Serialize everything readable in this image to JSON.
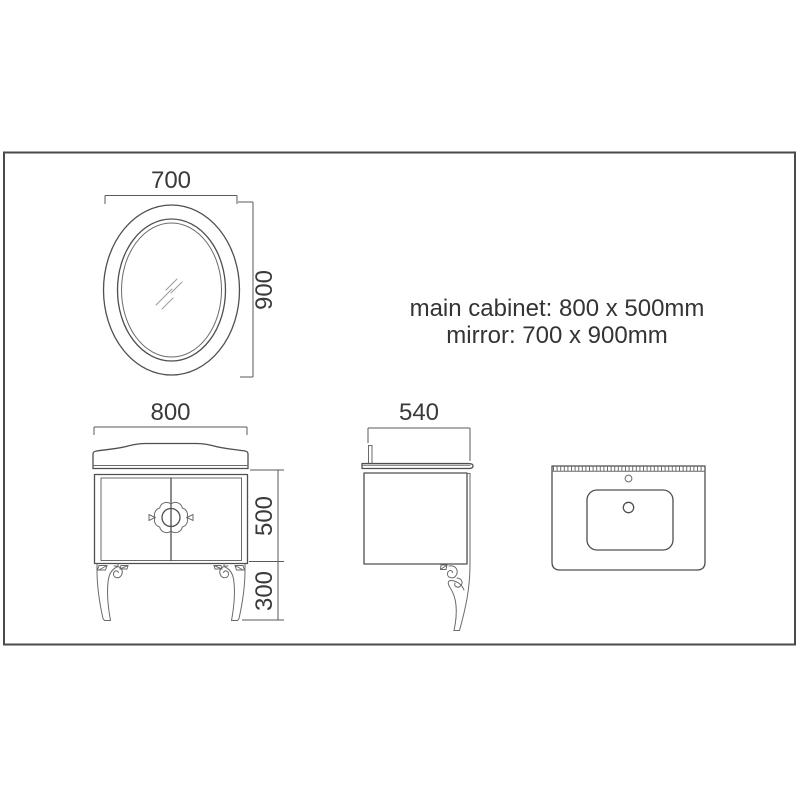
{
  "drawing": {
    "background": "#ffffff",
    "line_color": "#4f4f4f",
    "text_color": "#3a3a3a",
    "annotation": {
      "line1": "main cabinet: 800 x 500mm",
      "line2": "mirror: 700 x 900mm"
    },
    "mirror": {
      "width_mm": "700",
      "height_mm": "900"
    },
    "cabinet_front": {
      "width_mm": "800",
      "body_height_mm": "500",
      "leg_height_mm": "300"
    },
    "cabinet_side": {
      "depth_mm": "540"
    }
  }
}
